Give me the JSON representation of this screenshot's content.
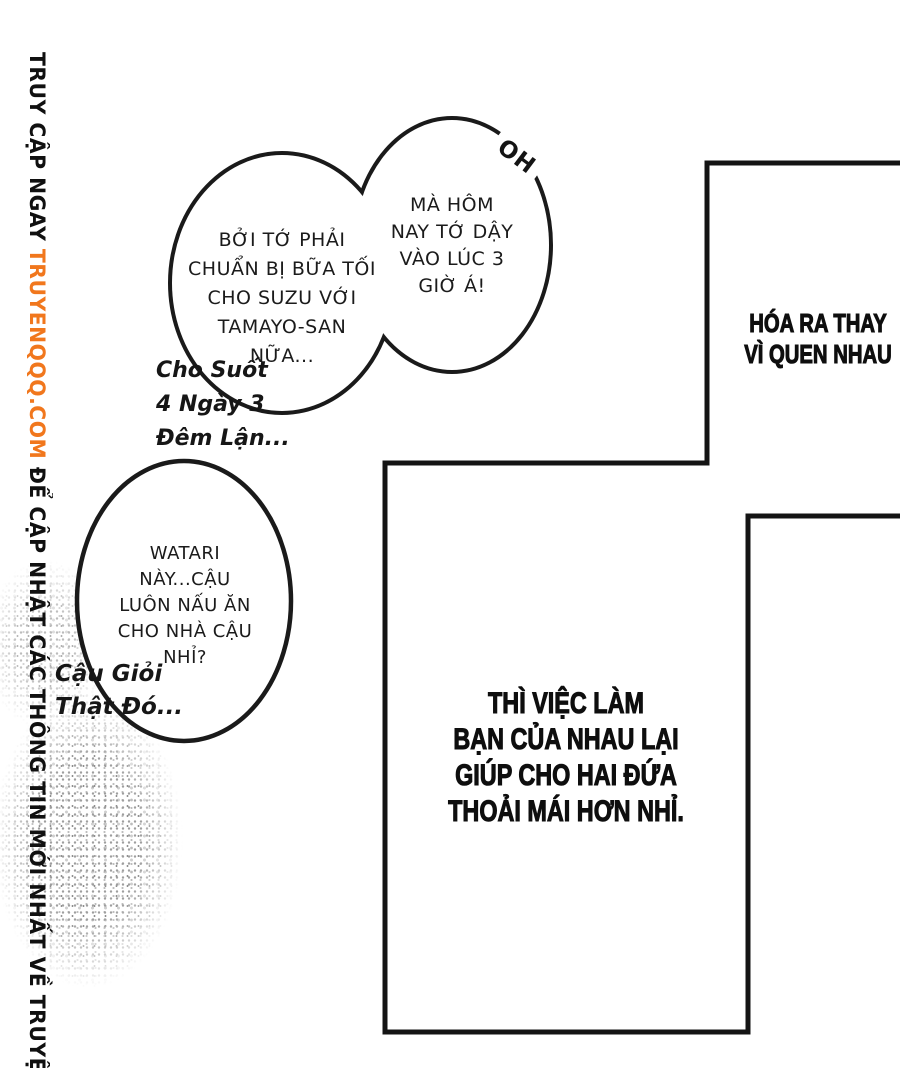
{
  "page": {
    "background": "#ffffff",
    "ink_color": "#141414",
    "accent_color": "#f1771d"
  },
  "watermark": {
    "prefix": "TRUY CẬP NGAY ",
    "site": "TRUYENQQQ.COM",
    "suffix": " ĐỂ CẬP NHẬT CÁC THÔNG TIN MỚI NHẤT VỀ TRUYỆN"
  },
  "bubbles": {
    "top_left": {
      "lines": [
        "BỞI TỚ PHẢI",
        "CHUẨN BỊ BỮA TỐI",
        "CHO SUZU VỚI",
        "TAMAYO-SAN",
        "NỮA..."
      ]
    },
    "top_right": {
      "lines": [
        "MÀ HÔM",
        "NAY TỚ DẬY",
        "VÀO LÚC 3",
        "GIỜ Á!"
      ],
      "exclaim": "OH"
    },
    "mid_left": {
      "lines": [
        "WATARI",
        "NÀY...CẬU",
        "LUÔN NẤU ĂN",
        "CHO NHÀ CẬU",
        "NHỈ?"
      ]
    }
  },
  "handwritten": {
    "note1": [
      "Cho Suốt",
      "4 Ngày 3",
      "Đêm Lận..."
    ],
    "note2": [
      "Cậu Giỏi",
      "Thật Đó..."
    ]
  },
  "captions": {
    "top_right": [
      "HÓA RA THAY",
      "VÌ QUEN NHAU"
    ],
    "bottom_center": [
      "THÌ VIỆC LÀM",
      "BẠN CỦA NHAU LẠI",
      "GIÚP CHO HAI ĐỨA",
      "THOẢI MÁI HƠN NHỈ."
    ]
  }
}
